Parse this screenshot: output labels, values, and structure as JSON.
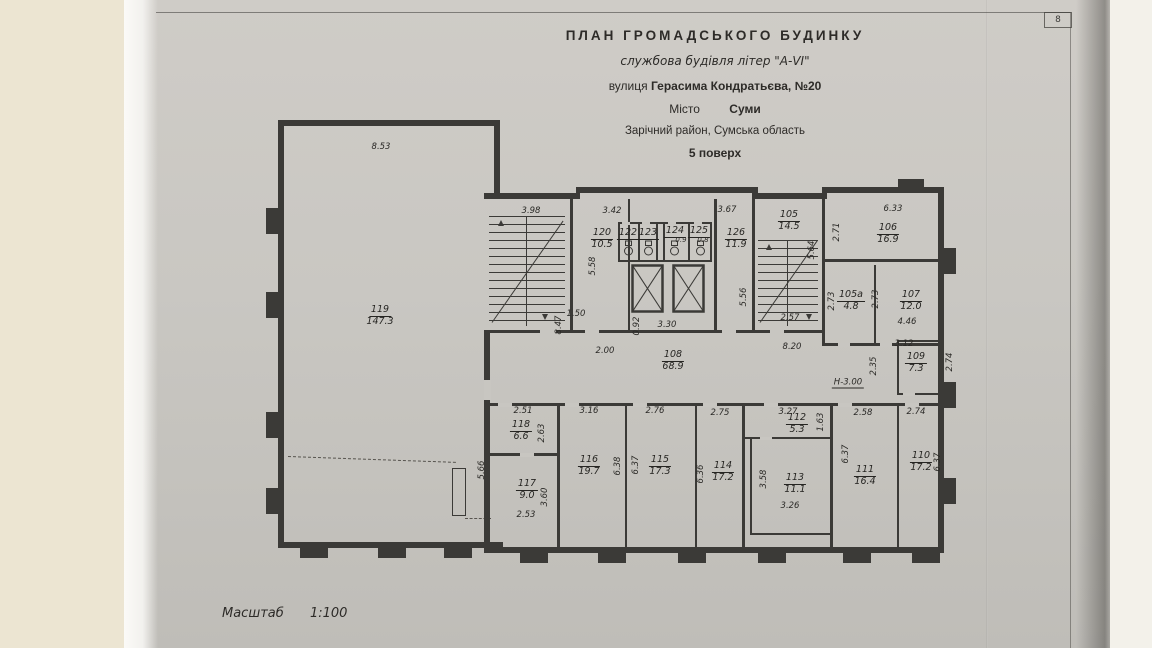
{
  "page": {
    "corner_number": "8"
  },
  "title_block": {
    "line1": "ПЛАН  ГРОМАДСЬКОГО  БУДИНКУ",
    "line2": "службова будівля літер \"А-VI\"",
    "street_label": "вулиця",
    "street_value": "Герасима Кондратьєва, №20",
    "city_label": "Місто",
    "city_value": "Суми",
    "district": "Зарічний район, Сумська область",
    "floor": "5 поверх"
  },
  "scale": {
    "label": "Масштаб",
    "value": "1:100"
  },
  "colors": {
    "paper": "#c8c6c1",
    "ink": "#3b3a37",
    "backing": "#ece5d2"
  },
  "plan": {
    "height_note": "Н-3.00",
    "rooms": [
      {
        "no": "119",
        "area": "147.3",
        "x": 380,
        "y": 305
      },
      {
        "no": "120",
        "area": "10.5",
        "x": 602,
        "y": 228
      },
      {
        "no": "122",
        "x": 628,
        "y": 228
      },
      {
        "no": "123",
        "x": 648,
        "y": 228
      },
      {
        "no": "124",
        "x": 675,
        "y": 226
      },
      {
        "no": "125",
        "x": 699,
        "y": 226
      },
      {
        "no": "126",
        "area": "11.9",
        "x": 736,
        "y": 228
      },
      {
        "no": "105",
        "area": "14.5",
        "x": 789,
        "y": 210
      },
      {
        "no": "106",
        "area": "16.9",
        "x": 888,
        "y": 223
      },
      {
        "no": "105а",
        "area": "4.8",
        "x": 851,
        "y": 290
      },
      {
        "no": "107",
        "area": "12.0",
        "x": 911,
        "y": 290
      },
      {
        "no": "108",
        "area": "68.9",
        "x": 673,
        "y": 350
      },
      {
        "no": "109",
        "area": "7.3",
        "x": 916,
        "y": 352
      },
      {
        "no": "118",
        "area": "6.6",
        "x": 521,
        "y": 420
      },
      {
        "no": "117",
        "area": "9.0",
        "x": 527,
        "y": 479
      },
      {
        "no": "116",
        "area": "19.7",
        "x": 589,
        "y": 455
      },
      {
        "no": "115",
        "area": "17.3",
        "x": 660,
        "y": 455
      },
      {
        "no": "114",
        "area": "17.2",
        "x": 723,
        "y": 461
      },
      {
        "no": "112",
        "area": "5.3",
        "x": 797,
        "y": 413
      },
      {
        "no": "113",
        "area": "11.1",
        "x": 795,
        "y": 473
      },
      {
        "no": "111",
        "area": "16.4",
        "x": 865,
        "y": 465
      },
      {
        "no": "110",
        "area": "17.2",
        "x": 921,
        "y": 451
      }
    ],
    "dims": [
      {
        "t": "8.53",
        "x": 381,
        "y": 147
      },
      {
        "t": "3.98",
        "x": 531,
        "y": 211
      },
      {
        "t": "3.42",
        "x": 612,
        "y": 211
      },
      {
        "t": "3.67",
        "x": 727,
        "y": 210
      },
      {
        "t": "6.33",
        "x": 893,
        "y": 209
      },
      {
        "t": "2.71",
        "x": 837,
        "y": 232,
        "r": 1
      },
      {
        "t": "5.58",
        "x": 593,
        "y": 266,
        "r": 1
      },
      {
        "t": "8.47",
        "x": 559,
        "y": 325,
        "r": 1
      },
      {
        "t": "1.50",
        "x": 576,
        "y": 314
      },
      {
        "t": "0.92",
        "x": 637,
        "y": 326,
        "r": 1
      },
      {
        "t": "3.30",
        "x": 667,
        "y": 325
      },
      {
        "t": "5.56",
        "x": 744,
        "y": 297,
        "r": 1
      },
      {
        "t": "5.64",
        "x": 812,
        "y": 250,
        "r": 1
      },
      {
        "t": "2.57",
        "x": 790,
        "y": 318
      },
      {
        "t": "2.00",
        "x": 605,
        "y": 351
      },
      {
        "t": "8.20",
        "x": 792,
        "y": 347
      },
      {
        "t": "Н-3.00",
        "x": 848,
        "y": 383,
        "u": 1
      },
      {
        "t": "2.73",
        "x": 832,
        "y": 301,
        "r": 1
      },
      {
        "t": "2.73",
        "x": 876,
        "y": 299,
        "r": 1
      },
      {
        "t": "4.46",
        "x": 907,
        "y": 322
      },
      {
        "t": "3.12",
        "x": 904,
        "y": 344
      },
      {
        "t": "2.35",
        "x": 874,
        "y": 366,
        "r": 1
      },
      {
        "t": "2.74",
        "x": 950,
        "y": 362,
        "r": 1
      },
      {
        "t": "0.9",
        "x": 681,
        "y": 240,
        "s": 1
      },
      {
        "t": "0.8",
        "x": 703,
        "y": 240,
        "s": 1
      },
      {
        "t": "2.51",
        "x": 523,
        "y": 411
      },
      {
        "t": "2.63",
        "x": 542,
        "y": 433,
        "r": 1
      },
      {
        "t": "5.66",
        "x": 482,
        "y": 470,
        "r": 1
      },
      {
        "t": "3.60",
        "x": 545,
        "y": 497,
        "r": 1
      },
      {
        "t": "2.53",
        "x": 526,
        "y": 515
      },
      {
        "t": "3.16",
        "x": 589,
        "y": 411
      },
      {
        "t": "6.38",
        "x": 618,
        "y": 466,
        "r": 1
      },
      {
        "t": "6.37",
        "x": 636,
        "y": 465,
        "r": 1
      },
      {
        "t": "2.76",
        "x": 655,
        "y": 411
      },
      {
        "t": "6.36",
        "x": 701,
        "y": 474,
        "r": 1
      },
      {
        "t": "2.75",
        "x": 720,
        "y": 413
      },
      {
        "t": "3.27",
        "x": 788,
        "y": 412
      },
      {
        "t": "1.63",
        "x": 821,
        "y": 422,
        "r": 1
      },
      {
        "t": "3.58",
        "x": 764,
        "y": 479,
        "r": 1
      },
      {
        "t": "3.26",
        "x": 790,
        "y": 506
      },
      {
        "t": "2.58",
        "x": 863,
        "y": 413
      },
      {
        "t": "6.37",
        "x": 846,
        "y": 454,
        "r": 1
      },
      {
        "t": "2.74",
        "x": 916,
        "y": 412
      },
      {
        "t": "6.37",
        "x": 938,
        "y": 462,
        "r": 1
      }
    ]
  }
}
